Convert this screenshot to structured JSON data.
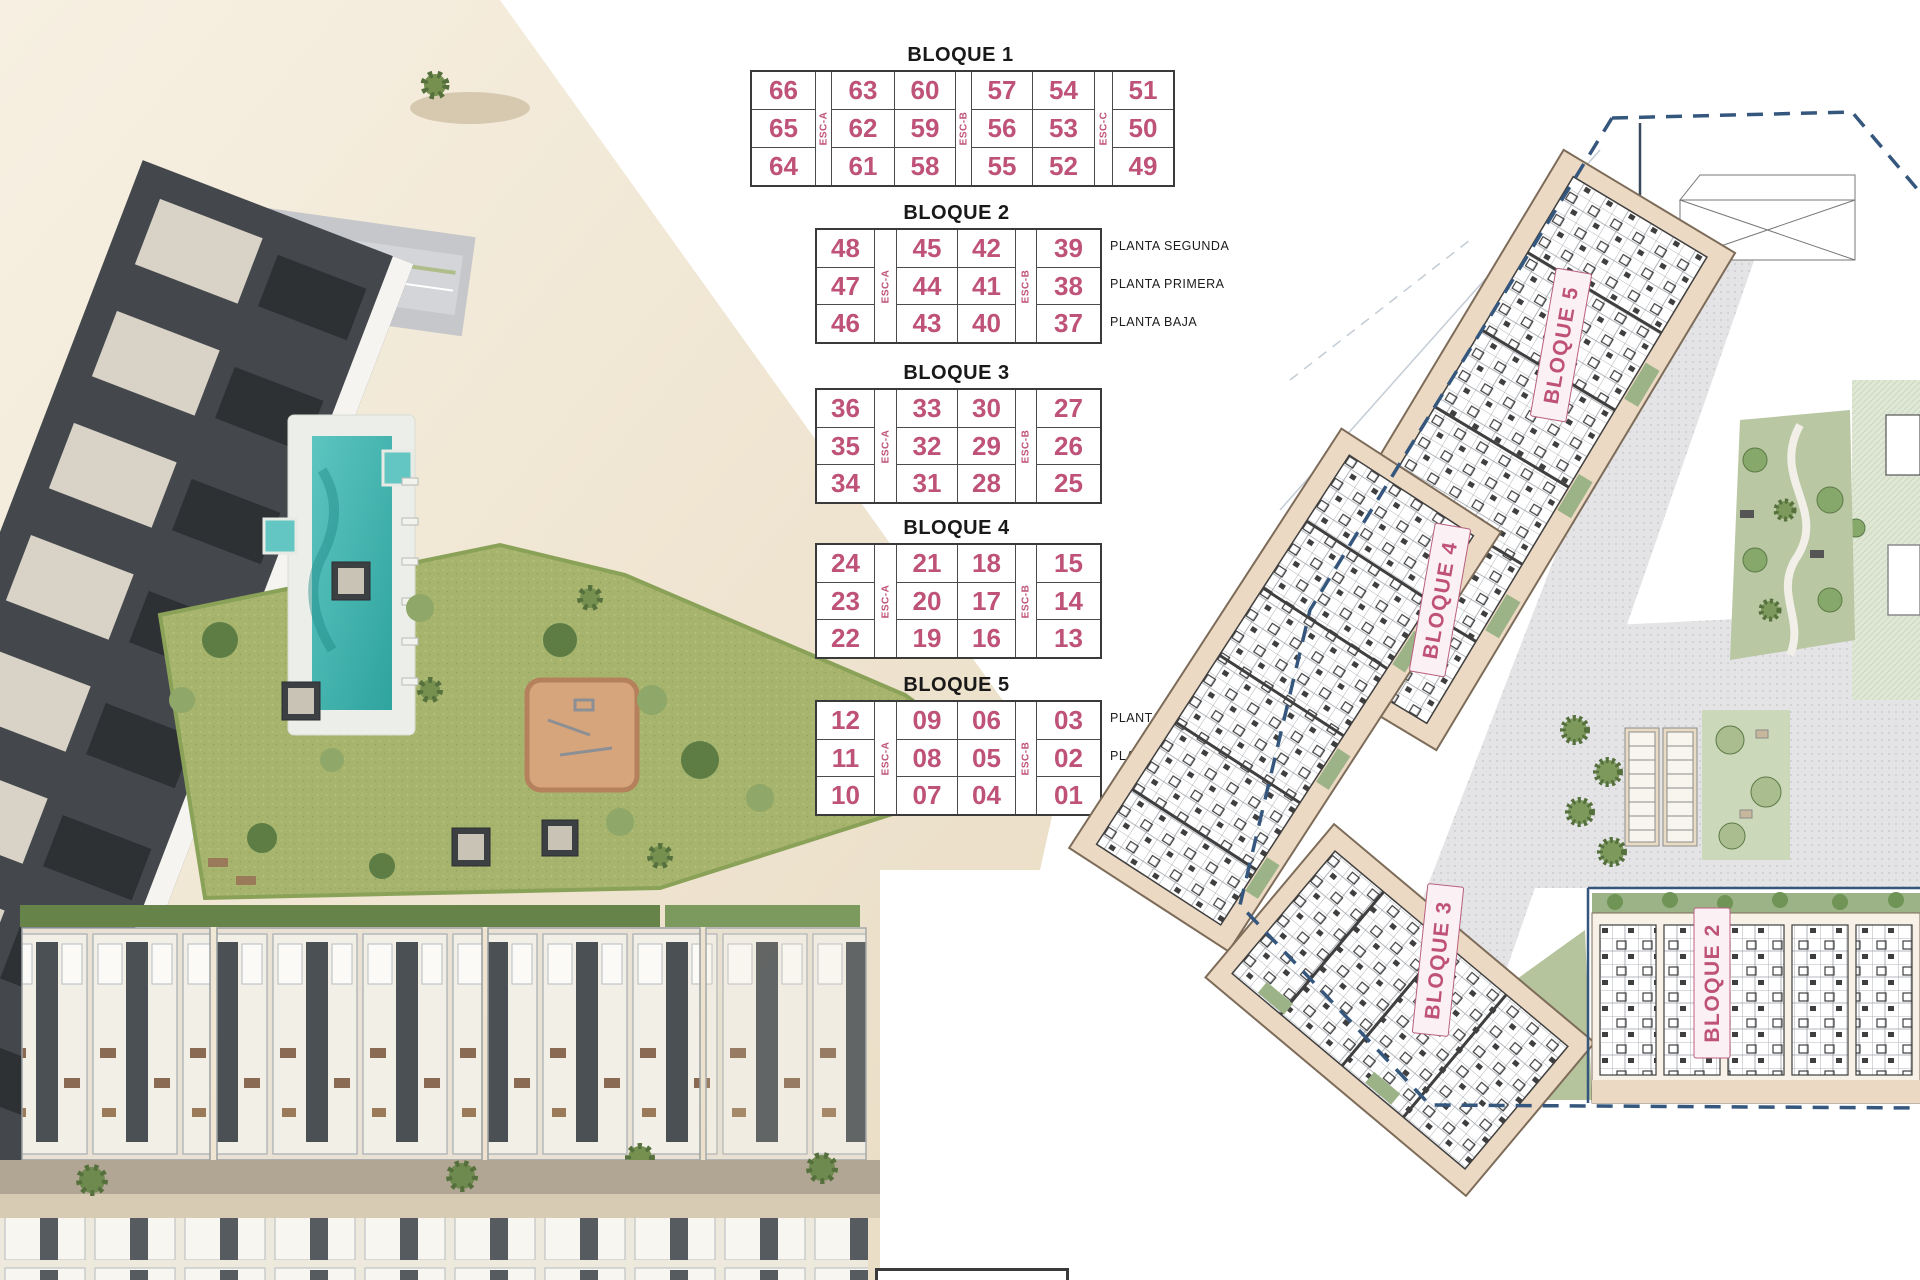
{
  "page": {
    "background": "#ffffff"
  },
  "colors": {
    "number_pink": "#bf5278",
    "title_black": "#191919",
    "boundary_navy": "#35577d",
    "building_tan": "#ecd9c3",
    "pool_teal": "#45b8b4",
    "lawn_green": "#a7b46d"
  },
  "tables": [
    {
      "title": "BLOQUE 1",
      "stairs": [
        "ESC-A",
        "ESC-B",
        "ESC-C"
      ],
      "planta": [],
      "rows": [
        [
          "66",
          "63",
          "60",
          "57",
          "54",
          "51"
        ],
        [
          "65",
          "62",
          "59",
          "56",
          "53",
          "50"
        ],
        [
          "64",
          "61",
          "58",
          "55",
          "52",
          "49"
        ]
      ]
    },
    {
      "title": "BLOQUE 2",
      "stairs": [
        "ESC-A",
        "ESC-B"
      ],
      "planta": [
        "PLANTA SEGUNDA",
        "PLANTA PRIMERA",
        "PLANTA BAJA"
      ],
      "rows": [
        [
          "48",
          "45",
          "42",
          "39"
        ],
        [
          "47",
          "44",
          "41",
          "38"
        ],
        [
          "46",
          "43",
          "40",
          "37"
        ]
      ]
    },
    {
      "title": "BLOQUE 3",
      "stairs": [
        "ESC-A",
        "ESC-B"
      ],
      "planta": [],
      "rows": [
        [
          "36",
          "33",
          "30",
          "27"
        ],
        [
          "35",
          "32",
          "29",
          "26"
        ],
        [
          "34",
          "31",
          "28",
          "25"
        ]
      ]
    },
    {
      "title": "BLOQUE 4",
      "stairs": [
        "ESC-A",
        "ESC-B"
      ],
      "planta": [],
      "rows": [
        [
          "24",
          "21",
          "18",
          "15"
        ],
        [
          "23",
          "20",
          "17",
          "14"
        ],
        [
          "22",
          "19",
          "16",
          "13"
        ]
      ]
    },
    {
      "title": "BLOQUE 5",
      "stairs": [
        "ESC-A",
        "ESC-B"
      ],
      "planta": [
        "PLANTA SEGUNDA",
        "PLANTA PRIMERA",
        "PLANTA BAJA"
      ],
      "rows": [
        [
          "12",
          "09",
          "06",
          "03"
        ],
        [
          "11",
          "08",
          "05",
          "02"
        ],
        [
          "10",
          "07",
          "04",
          "01"
        ]
      ]
    }
  ],
  "plan": {
    "labels": [
      {
        "text": "BLOQUE 5"
      },
      {
        "text": "BLOQUE 4"
      },
      {
        "text": "BLOQUE 3"
      },
      {
        "text": "BLOQUE 2"
      }
    ]
  }
}
